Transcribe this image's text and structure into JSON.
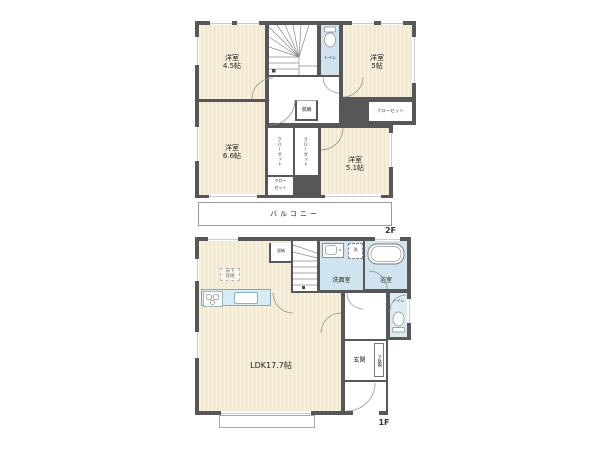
{
  "floors": {
    "second": {
      "label": "2F",
      "rooms": {
        "yoshitsu45": {
          "name": "洋室",
          "size": "4.5帖"
        },
        "yoshitsu5": {
          "name": "洋室",
          "size": "5帖"
        },
        "yoshitsu66": {
          "name": "洋室",
          "size": "6.6帖"
        },
        "yoshitsu51": {
          "name": "洋室",
          "size": "5.1帖"
        },
        "toilet": "トイレ",
        "storage": "収納",
        "closet": "クローゼット",
        "closet_small_line1": "クロー",
        "closet_small_line2": "ゼット",
        "balcony": "バルコニー"
      }
    },
    "first": {
      "label": "1F",
      "rooms": {
        "ldk": "LDK17.7帖",
        "storage": "収納",
        "washroom": "洗面室",
        "washer": "洗",
        "bath": "浴室",
        "toilet": "トイレ",
        "entrance": "玄関",
        "shoe_cabinet": "下駄箱",
        "underfloor_line1": "床下",
        "underfloor_line2": "収納"
      }
    }
  },
  "colors": {
    "wall": "#575757",
    "flooring": "#f5efdb",
    "flooring_stripe": "#ebe3cc",
    "wet_area": "#cfe4ef",
    "kitchen_counter": "#d9ebf5"
  }
}
